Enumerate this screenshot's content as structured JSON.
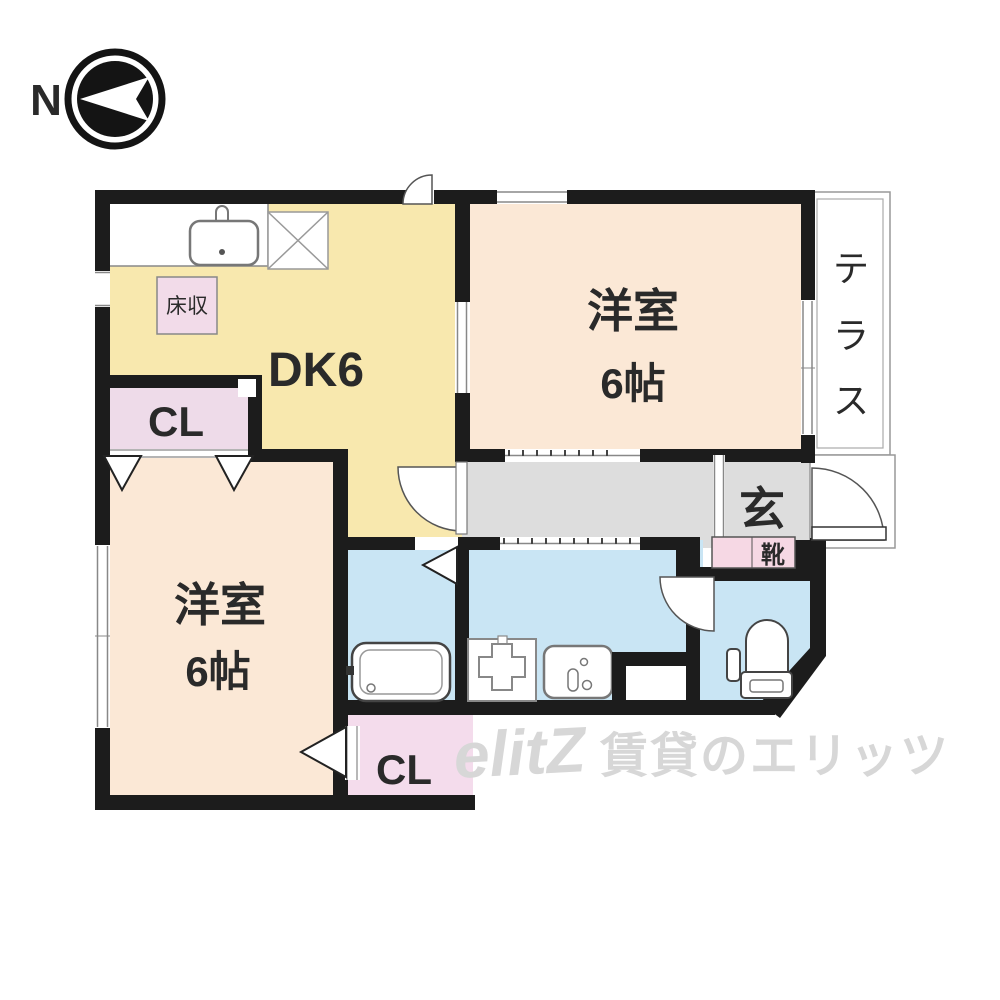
{
  "compass": {
    "north_label": "N"
  },
  "rooms": {
    "dk": {
      "label": "DK6",
      "floor_storage": "床収"
    },
    "western_room_top": {
      "name": "洋室",
      "size": "6帖"
    },
    "western_room_bottom": {
      "name": "洋室",
      "size": "6帖"
    },
    "closet_left": {
      "label": "CL"
    },
    "closet_bottom": {
      "label": "CL"
    },
    "terrace": {
      "label": "テラス",
      "chars": [
        "テ",
        "ラ",
        "ス"
      ]
    },
    "entrance": {
      "label": "玄",
      "shoe_label": "靴"
    }
  },
  "watermark": {
    "logo": "elitZ",
    "text": "賃貸のエリッツ"
  },
  "colors": {
    "wall": "#1c1c1c",
    "dk_floor": "#f8e8ae",
    "bedroom_floor": "#fbe8d6",
    "closet_floor": "#eedbe9",
    "wet_area_floor": "#c9e5f4",
    "corridor_floor": "#dddddd",
    "shoe_box": "#f6d8e4",
    "watermark_gray": "#d7d7d7"
  }
}
